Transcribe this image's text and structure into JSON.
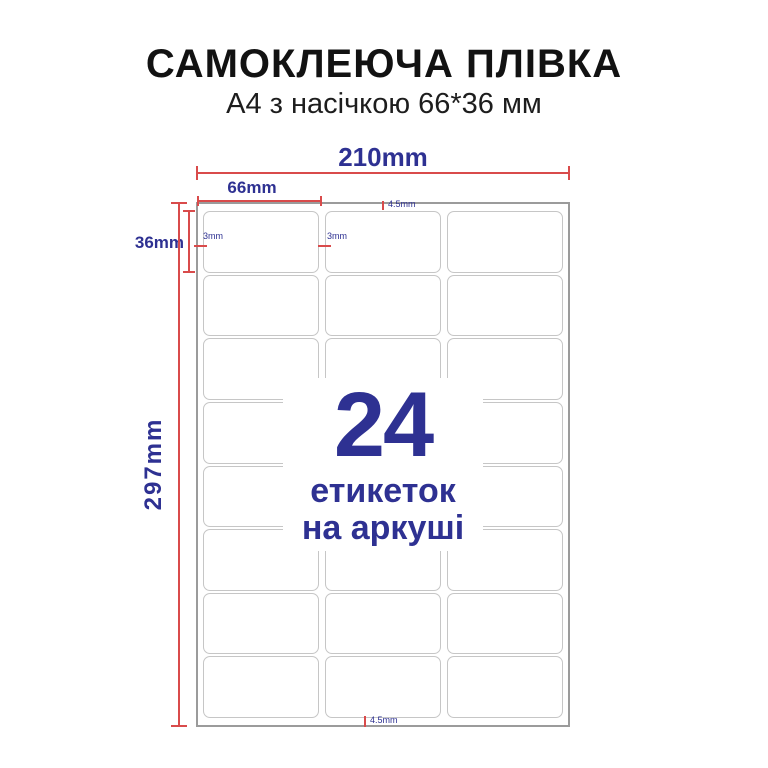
{
  "title": "САМОКЛЕЮЧА ПЛІВКА",
  "subtitle": "А4 з насічкою 66*36 мм",
  "overlay": {
    "count": "24",
    "caption_line1": "етикеток",
    "caption_line2": "на аркуші"
  },
  "dimensions": {
    "sheet_width": "210mm",
    "column_width": "66mm",
    "row_height": "36mm",
    "sheet_height": "297mm",
    "top_margin": "4.5mm",
    "bottom_margin": "4.5mm",
    "left_gap": "3mm",
    "column_gap": "3mm"
  },
  "sheet": {
    "rows": 8,
    "columns": 3,
    "labels_total": 24
  },
  "colors": {
    "accent_blue": "#2e3192",
    "dimension_red": "#d94b4b",
    "label_border": "#c6c6c6",
    "sheet_border": "#9b9b9b",
    "title_color": "#121212"
  }
}
